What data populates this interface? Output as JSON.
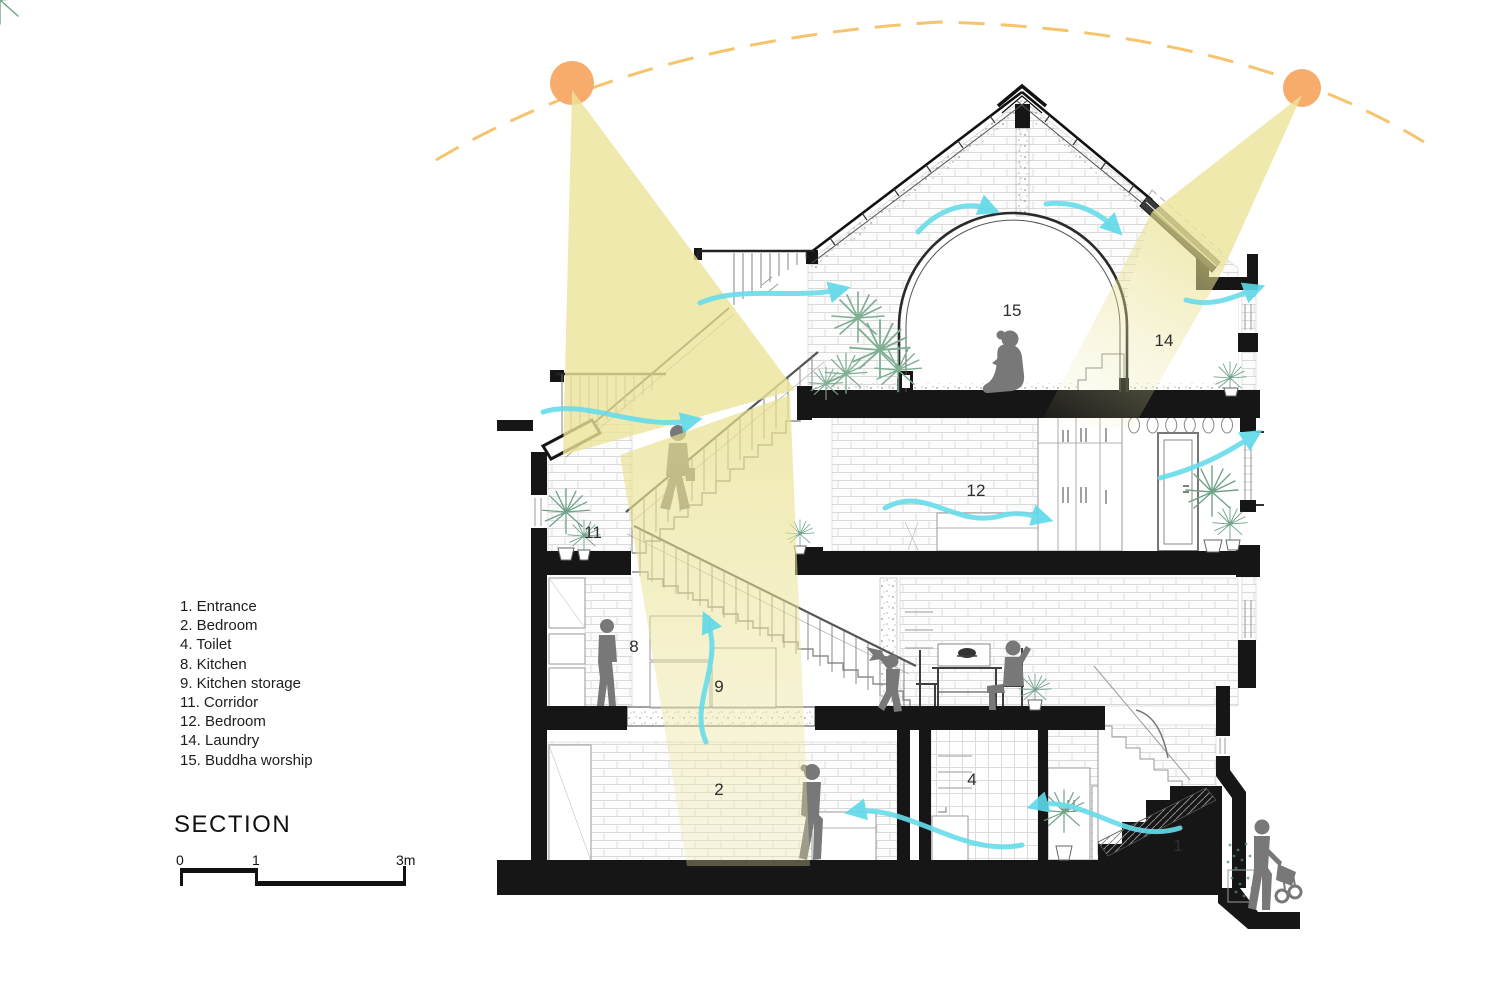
{
  "title": "SECTION",
  "legend": [
    "1. Entrance",
    "2. Bedroom",
    "4. Toilet",
    "8. Kitchen",
    "9. Kitchen storage",
    "11. Corridor",
    "12. Bedroom",
    "14. Laundry",
    "15. Buddha worship"
  ],
  "scale": [
    "0",
    "1",
    "3m"
  ],
  "rooms": {
    "r1": "1",
    "r2": "2",
    "r4": "4",
    "r8": "8",
    "r9": "9",
    "r11": "11",
    "r12": "12",
    "r14": "14",
    "r15": "15"
  },
  "colors": {
    "sun": "#F7AC6C",
    "sun_path": "#F6C46E",
    "light_beam": "#ECE49A",
    "airflow": "#68DCEB",
    "vegetation": "#7FAE92",
    "figure": "#787878",
    "structure": "#161616"
  }
}
